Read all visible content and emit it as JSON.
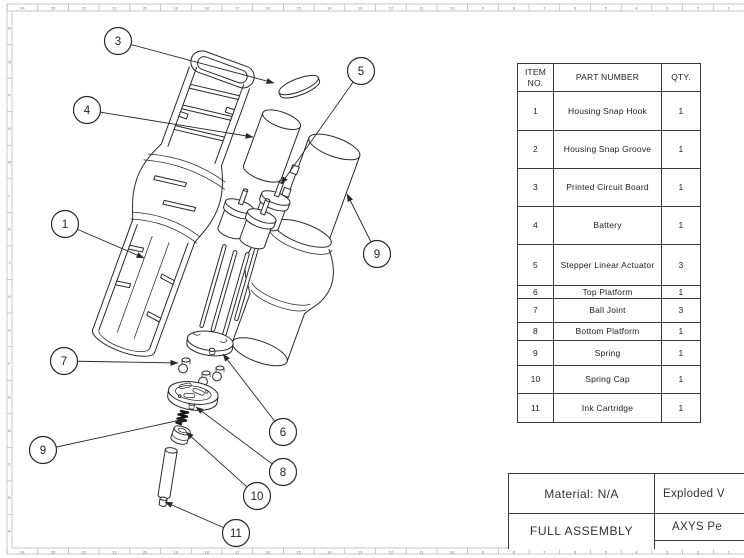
{
  "sheet": {
    "rulers": {
      "top": [
        "24",
        "23",
        "22",
        "21",
        "20",
        "19",
        "18",
        "17",
        "16",
        "15",
        "14",
        "13",
        "12",
        "11",
        "10",
        "9",
        "8",
        "7",
        "6",
        "5",
        "4",
        "3",
        "2",
        "1"
      ],
      "bottom": [
        "24",
        "23",
        "22",
        "21",
        "20",
        "19",
        "18",
        "17",
        "16",
        "15",
        "14",
        "13",
        "12",
        "11",
        "10",
        "9",
        "8",
        "7",
        "6",
        "5",
        "4",
        "3",
        "2",
        "1"
      ],
      "left": [
        "R",
        "Q",
        "P",
        "N",
        "M",
        "L",
        "K",
        "J",
        "H",
        "G",
        "F",
        "E",
        "D",
        "C",
        "B",
        "A"
      ]
    }
  },
  "bom": {
    "headers": {
      "item": "ITEM NO.",
      "part": "PART NUMBER",
      "qty": "QTY."
    },
    "rows": [
      {
        "item": "1",
        "part": "Housing Snap Hook",
        "qty": "1"
      },
      {
        "item": "2",
        "part": "Housing Snap Groove",
        "qty": "1"
      },
      {
        "item": "3",
        "part": "Printed Circuit Board",
        "qty": "1"
      },
      {
        "item": "4",
        "part": "Battery",
        "qty": "1"
      },
      {
        "item": "5",
        "part": "Stepper Linear Actuator",
        "qty": "3"
      },
      {
        "item": "6",
        "part": "Top Platform",
        "qty": "1"
      },
      {
        "item": "7",
        "part": "Ball Joint",
        "qty": "3"
      },
      {
        "item": "8",
        "part": "Bottom Platform",
        "qty": "1"
      },
      {
        "item": "9",
        "part": "Spring",
        "qty": "1"
      },
      {
        "item": "10",
        "part": "Spring Cap",
        "qty": "1"
      },
      {
        "item": "11",
        "part": "Ink Cartridge",
        "qty": "1"
      }
    ]
  },
  "title_block": {
    "material": "Material: N/A",
    "assembly": "FULL ASSEMBLY",
    "drawing_title": "Exploded V",
    "project": "AXYS Pe"
  },
  "balloons": {
    "b1": {
      "label": "1"
    },
    "b3": {
      "label": "3"
    },
    "b4": {
      "label": "4"
    },
    "b5": {
      "label": "5"
    },
    "b6": {
      "label": "6"
    },
    "b7": {
      "label": "7"
    },
    "b8": {
      "label": "8"
    },
    "b9_left": {
      "label": "9"
    },
    "b9_right": {
      "label": "9"
    },
    "b10": {
      "label": "10"
    },
    "b11": {
      "label": "11"
    }
  }
}
